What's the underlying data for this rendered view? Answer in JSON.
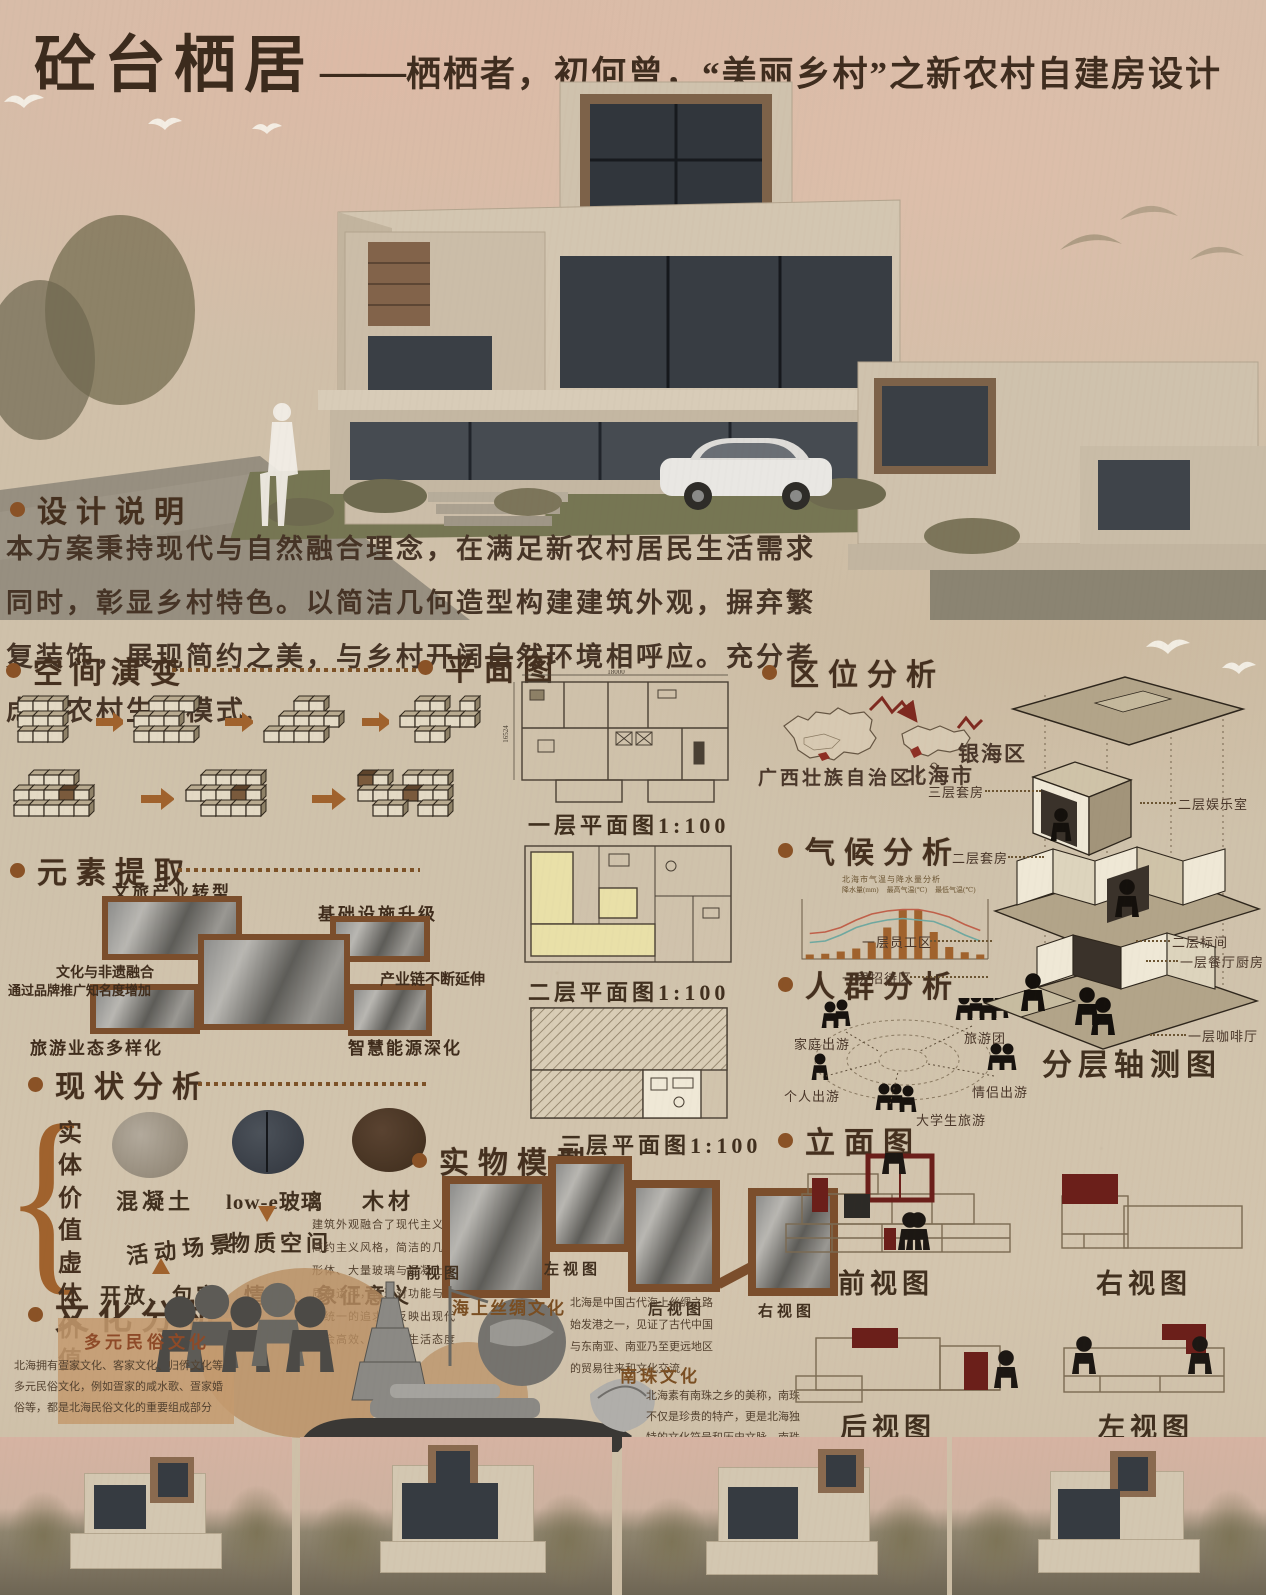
{
  "poster": {
    "title_main": "砼台栖居",
    "title_dash": "——",
    "title_sub": "栖栖者，初何曾，“美丽乡村”之新农村自建房设计"
  },
  "design_notes": {
    "heading": "设计说明",
    "body": "本方案秉持现代与自然融合理念，在满足新农村居民生活需求同时，彰显乡村特色。以简洁几何造型构建建筑外观，摒弃繁复装饰，展现简约之美，与乡村开阔自然环境相呼应。充分考虑新农村生活模式."
  },
  "space_evolution": {
    "heading": "空间演变"
  },
  "floor_plans": {
    "heading": "平面图",
    "labels": [
      "一层平面图1:100",
      "二层平面图1:100",
      "三层平面图1:100"
    ],
    "dims": {
      "plan1_width": "18000",
      "plan1_height": "16524"
    }
  },
  "location": {
    "heading": "区位分析",
    "labels": [
      "广西壮族自治区",
      "北海市",
      "银海区"
    ]
  },
  "climate": {
    "heading": "气候分析"
  },
  "people": {
    "heading": "人群分析",
    "labels": [
      "家庭出游",
      "个人出游",
      "大学生旅游",
      "旅游团",
      "情侣出游"
    ]
  },
  "elements": {
    "heading": "元素提取",
    "labels": [
      "文旅产业转型",
      "基础设施升级",
      "文化与非遗融合",
      "通过品牌推广知名度增加",
      "产业链不断延伸",
      "旅游业态多样化",
      "智慧能源深化"
    ]
  },
  "status": {
    "heading": "现状分析",
    "solid": "实体价值",
    "virtual": "虚体价值",
    "materials": [
      "混凝土",
      "low-e玻璃",
      "木材"
    ],
    "material_space": "物质空间",
    "activity": "活动场景",
    "virtual_values": "开放、包容、情感、象征意义",
    "note": "建筑外观融合了现代主义与简约主义风格，简洁的几何形体、大量玻璃与混凝土材质的运用，体现对功能与形式统一的追求，反映出现代社会高效、理性的生活态度"
  },
  "model": {
    "heading": "实物模型",
    "views": [
      "前视图",
      "左视图",
      "后视图",
      "右视图"
    ]
  },
  "culture": {
    "heading": "文化分析",
    "items": [
      {
        "title": "海上丝绸文化",
        "text": "北海是中国古代海上丝绸之路始发港之一，见证了古代中国与东南亚、南亚乃至更远地区的贸易往来和文化交流"
      },
      {
        "title": "多元民俗文化",
        "text": "北海拥有疍家文化、客家文化、归侨文化等多元民俗文化，例如疍家的咸水歌、疍家婚俗等，都是北海民俗文化的重要组成部分"
      },
      {
        "title": "南珠文化",
        "text": "北海素有南珠之乡的美称，南珠不仅是珍贵的特产，更是北海独特的文化符号和历史文脉，南珠传统养殖技艺传承至今。"
      }
    ]
  },
  "elevations": {
    "heading": "立面图",
    "views": [
      "前视图",
      "右视图",
      "后视图",
      "左视图"
    ]
  },
  "axon": {
    "caption": "分层轴测图",
    "labels_left": [
      "三层套房",
      "二层套房",
      "一层员工区",
      "一层招待区"
    ],
    "labels_right": [
      "二层娱乐室",
      "二层标间",
      "一层餐厅厨房",
      "一层咖啡厅"
    ]
  },
  "colors": {
    "accent": "#8a5226",
    "frame": "#7b4e2c",
    "dark_red": "#6b1f1a",
    "bar": "#a0622d",
    "line_high": "#c0604a",
    "line_low": "#6fa8a0",
    "paper": "#cfc0ab"
  },
  "chart_data": {
    "type": "bar",
    "title": "北海市气温与降水量分析",
    "categories": [
      "1月",
      "2月",
      "3月",
      "4月",
      "5月",
      "6月",
      "7月",
      "8月",
      "9月",
      "10月",
      "11月",
      "12月"
    ],
    "series": [
      {
        "name": "降水量(mm)",
        "kind": "bar",
        "values": [
          30,
          35,
          50,
          70,
          110,
          210,
          330,
          330,
          180,
          80,
          45,
          30
        ]
      },
      {
        "name": "最高气温(℃)",
        "kind": "line",
        "values": [
          17,
          18,
          21,
          26,
          30,
          32,
          33,
          33,
          31,
          28,
          23,
          19
        ]
      },
      {
        "name": "最低气温(℃)",
        "kind": "line",
        "values": [
          11,
          12,
          16,
          21,
          24,
          26,
          27,
          26,
          25,
          21,
          16,
          12
        ]
      }
    ],
    "bar_max": 400,
    "temp_max": 40,
    "legend_position": "top",
    "grid": false
  }
}
